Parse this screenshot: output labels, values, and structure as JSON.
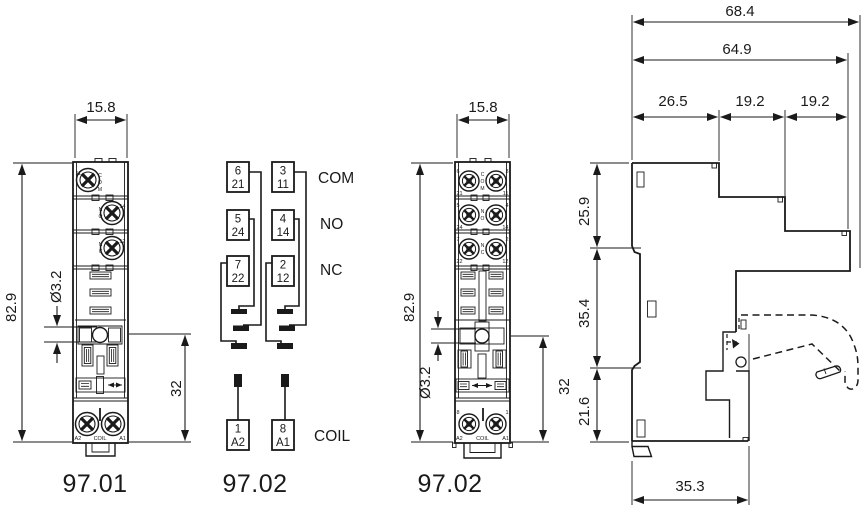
{
  "captions": {
    "v1": "97.01",
    "v2": "97.02",
    "v3": "97.02"
  },
  "front_9701": {
    "dims": {
      "width": "15.8",
      "height": "82.9",
      "hole": "Ø3.2",
      "offset": "32"
    },
    "row1": {
      "num": "11",
      "letters": [
        "C",
        "O",
        "M"
      ]
    },
    "row2": {
      "num": "14",
      "letters": [
        "N",
        "O"
      ]
    },
    "row3": {
      "num": "12",
      "letters": [
        "N",
        "C"
      ]
    },
    "coil": {
      "left": "A2",
      "mid": "COIL",
      "right": "A1"
    }
  },
  "schematic": {
    "rows": [
      {
        "lt": "6",
        "lb": "21",
        "rt": "3",
        "rb": "11",
        "label": "COM"
      },
      {
        "lt": "5",
        "lb": "24",
        "rt": "4",
        "rb": "14",
        "label": "NO"
      },
      {
        "lt": "7",
        "lb": "22",
        "rt": "2",
        "rb": "12",
        "label": "NC"
      }
    ],
    "coil": {
      "lt": "1",
      "lb": "A2",
      "rt": "8",
      "rb": "A1",
      "label": "COIL"
    }
  },
  "front_9702": {
    "dims": {
      "width": "15.8",
      "height": "82.9",
      "hole": "Ø3.2",
      "offset": "32"
    },
    "rows": [
      {
        "lt": "6",
        "lb": "21",
        "letters": [
          "C",
          "O",
          "M"
        ],
        "rt": "3",
        "rb": "11"
      },
      {
        "lt": "5",
        "lb": "24",
        "letters": [
          "N",
          "O"
        ],
        "rt": "4",
        "rb": "14"
      },
      {
        "lt": "7",
        "lb": "22",
        "letters": [
          "N",
          "C"
        ],
        "rt": "2",
        "rb": "12"
      }
    ],
    "coil": {
      "lt": "8",
      "lb": "A2",
      "mid": "COIL",
      "rt": "1",
      "rb": "A1"
    }
  },
  "side": {
    "total": "68.4",
    "body": "64.9",
    "seg1": "26.5",
    "seg2": "19.2",
    "seg3": "19.2",
    "h1": "25.9",
    "h2": "35.4",
    "h3": "21.6",
    "base": "35.3"
  }
}
